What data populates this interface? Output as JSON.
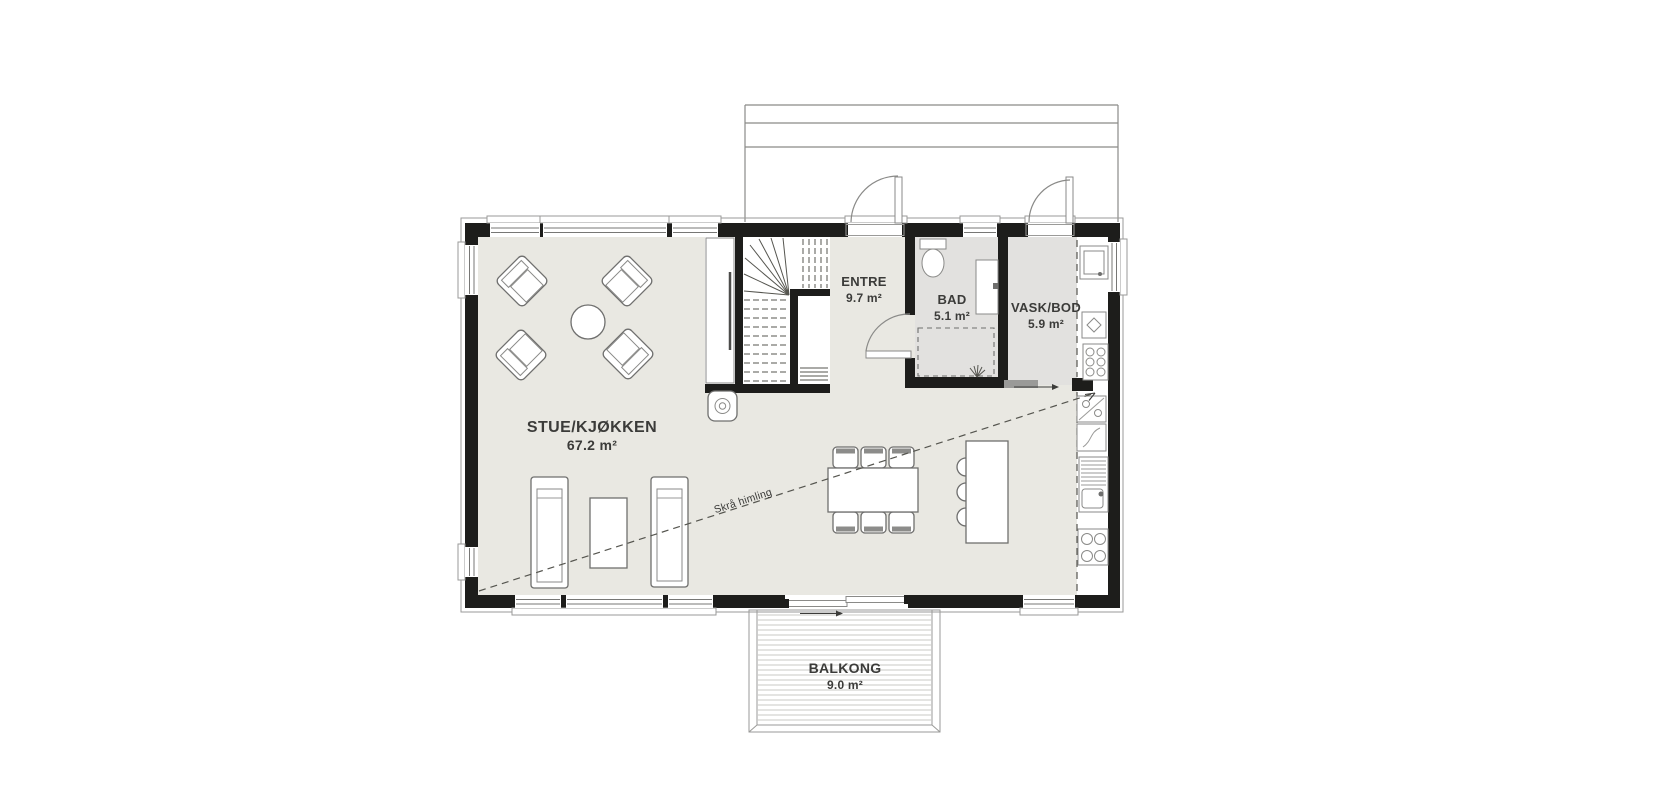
{
  "plan": {
    "rooms": [
      {
        "name": "STUE/KJØKKEN",
        "area": "67.2 m²"
      },
      {
        "name": "ENTRE",
        "area": "9.7 m²"
      },
      {
        "name": "BAD",
        "area": "5.1 m²"
      },
      {
        "name": "VASK/BOD",
        "area": "5.9 m²"
      },
      {
        "name": "BALKONG",
        "area": "9.0 m²"
      }
    ],
    "annotation": {
      "sloped_ceiling": "Skrå himling"
    },
    "colors": {
      "wall": "#1d1d1b",
      "floor_main": "#e9e8e2",
      "floor_wet": "#e2e1df",
      "line": "#6f6f6e",
      "deck_line": "#c9c9c6",
      "text": "#3b3b39"
    }
  }
}
